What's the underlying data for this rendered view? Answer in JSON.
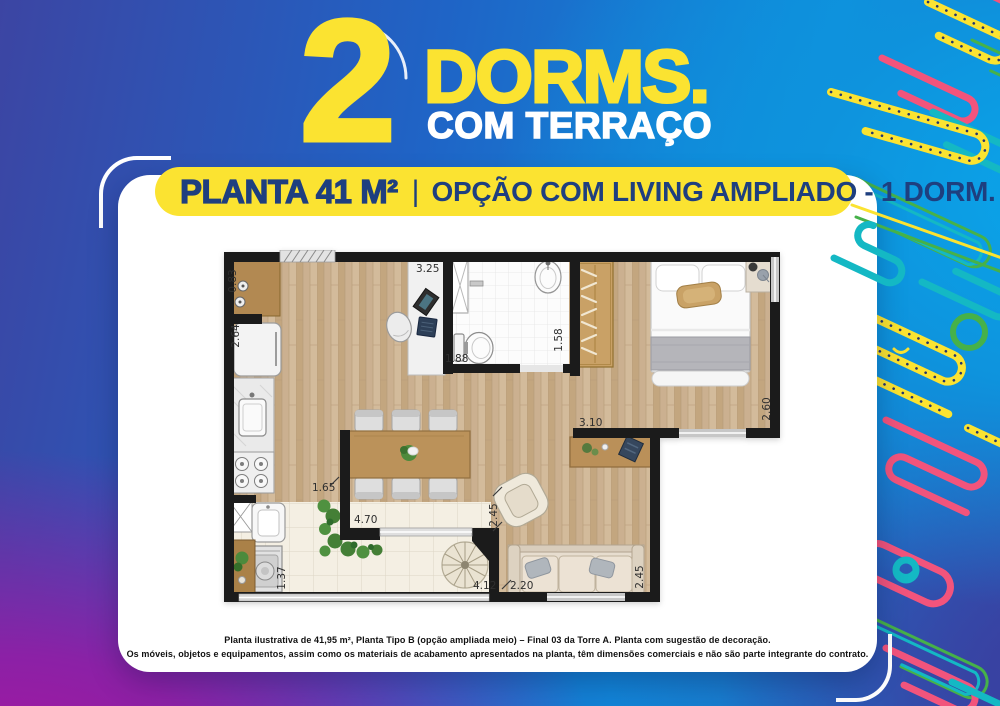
{
  "header": {
    "big_number": "2",
    "title": "DORMS.",
    "subtitle": "COM TERRAÇO"
  },
  "plan_banner": {
    "area_label": "PLANTA 41 M²",
    "divider": "|",
    "option_label": "OPÇÃO COM LIVING AMPLIADO - 1 DORM."
  },
  "floor_plan": {
    "dimensions": [
      {
        "id": "kitchen-counter",
        "value": "0.83",
        "orientation": "vertical"
      },
      {
        "id": "kitchen-depth",
        "value": "2.64",
        "orientation": "vertical"
      },
      {
        "id": "home-office",
        "value": "3.25",
        "orientation": "horizontal"
      },
      {
        "id": "bathroom-width",
        "value": "1.88",
        "orientation": "horizontal"
      },
      {
        "id": "bathroom-depth",
        "value": "1.58",
        "orientation": "vertical"
      },
      {
        "id": "bedroom-width",
        "value": "3.10",
        "orientation": "horizontal"
      },
      {
        "id": "bedroom-depth",
        "value": "2.60",
        "orientation": "vertical"
      },
      {
        "id": "kitchen-passage",
        "value": "1.65",
        "orientation": "horizontal"
      },
      {
        "id": "living-width",
        "value": "4.70",
        "orientation": "horizontal"
      },
      {
        "id": "living-depth",
        "value": "2.45",
        "orientation": "vertical"
      },
      {
        "id": "laundry-width",
        "value": "1.37",
        "orientation": "vertical"
      },
      {
        "id": "terrace-width",
        "value": "4.12",
        "orientation": "horizontal"
      },
      {
        "id": "sofa-width",
        "value": "2.20",
        "orientation": "horizontal"
      },
      {
        "id": "sofa-depth",
        "value": "2.45",
        "orientation": "vertical"
      }
    ]
  },
  "disclaimer": {
    "line1": "Planta ilustrativa de 41,95 m², Planta Tipo B (opção ampliada meio) – Final 03 da Torre A. Planta com sugestão de decoração.",
    "line2": "Os móveis, objetos e equipamentos, assim como os materiais de acabamento apresentados na planta, têm dimensões comerciais e não são parte integrante do contrato."
  },
  "colors": {
    "accent_yellow": "#fbe331",
    "brand_navy": "#1e3f7f",
    "background_blue": "#0d8fdd",
    "background_purple": "#a516a0",
    "squiggle_pink": "#f2547c",
    "squiggle_teal": "#14b8c4",
    "squiggle_green": "#46b149",
    "wall_black": "#1b1b1b"
  }
}
